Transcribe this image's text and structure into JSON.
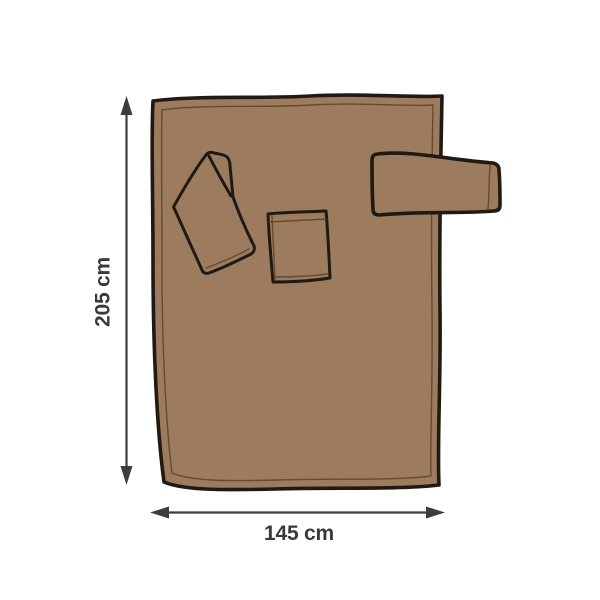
{
  "diagram": {
    "name": "blanket-size-diagram",
    "height_label": "205 cm",
    "width_label": "145 cm",
    "colors": {
      "background": "#ffffff",
      "blanket_fill": "#9c7b5e",
      "outline": "#211a12",
      "seam": "#5c4427",
      "arrow": "#3d3d3d",
      "label_text": "#3a3a3a"
    },
    "parts": {
      "body": "blanket-body",
      "folded_sleeve": "folded-sleeve",
      "pocket": "front-pocket",
      "side_sleeve": "protruding-sleeve"
    }
  }
}
